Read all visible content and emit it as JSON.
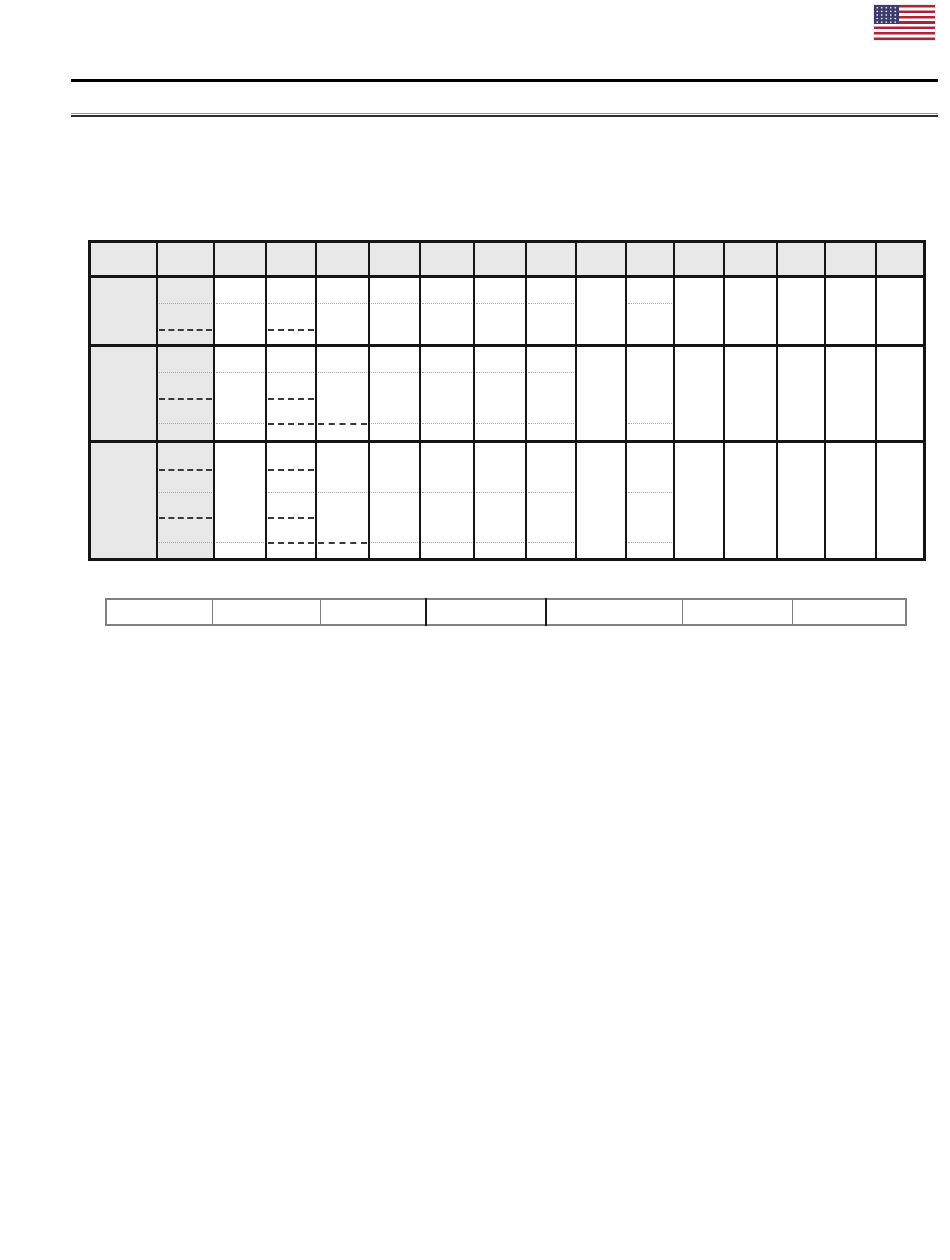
{
  "page": {
    "background": "#ffffff"
  },
  "header": {
    "flag": {
      "icon": "us-flag-icon",
      "stripe_red": "#b22234",
      "canton_blue": "#3c3b6e",
      "star_white": "#ffffff",
      "stripe_count": 13
    },
    "rules": {
      "primary_color": "#000000",
      "secondary_top_color": "#9a9a9a",
      "secondary_bottom_color": "#2f2f2f"
    }
  },
  "main_table": {
    "border_color": "#151515",
    "header_fill": "#e8e8e8",
    "label_fill": "#e8e8e8",
    "faint_line_color": "#a8a8a8",
    "dark_line_color": "#3a3a3a",
    "column_count": 16,
    "shaded_column_count": 2,
    "col_widths": [
      67,
      57,
      52,
      50,
      53,
      51,
      54,
      52,
      50,
      50,
      48,
      50,
      53,
      48,
      51,
      49
    ],
    "header_height": 35,
    "all_cells_blank": true,
    "row_groups": [
      {
        "height": 69,
        "lines": [
          {
            "offset": 25,
            "style": "faint",
            "cols": [
              2,
              3,
              4,
              5,
              6,
              7,
              8,
              9,
              11
            ]
          },
          {
            "offset": 51,
            "style": "dark",
            "cols": [
              2,
              4
            ]
          }
        ]
      },
      {
        "height": 96,
        "lines": [
          {
            "offset": 25,
            "style": "faint",
            "cols": [
              2,
              3,
              4,
              5,
              6,
              7,
              8,
              9
            ]
          },
          {
            "offset": 51,
            "style": "dark",
            "cols": [
              2,
              4
            ]
          },
          {
            "offset": 76,
            "style": "faint",
            "cols": [
              2,
              3,
              6,
              7,
              8,
              9,
              11
            ]
          },
          {
            "offset": 76,
            "style": "dark",
            "cols": [
              4,
              5
            ]
          }
        ]
      },
      {
        "height": 118,
        "lines": [
          {
            "offset": 26,
            "style": "dark",
            "cols": [
              2,
              4
            ]
          },
          {
            "offset": 49,
            "style": "faint",
            "cols": [
              2,
              4,
              5,
              6,
              7,
              8,
              9,
              11
            ]
          },
          {
            "offset": 74,
            "style": "dark",
            "cols": [
              2,
              4
            ]
          },
          {
            "offset": 99,
            "style": "faint",
            "cols": [
              2,
              3,
              6,
              7,
              8,
              9,
              11
            ]
          },
          {
            "offset": 99,
            "style": "dark",
            "cols": [
              4,
              5
            ]
          }
        ]
      }
    ]
  },
  "footer_table": {
    "border_color": "#808080",
    "dark_divider_color": "#1a1a1a",
    "col_widths": [
      106,
      108,
      106,
      120,
      136,
      110,
      114
    ],
    "row_height": 26,
    "dark_divider_after_columns": [
      3,
      4
    ],
    "all_cells_blank": true
  }
}
